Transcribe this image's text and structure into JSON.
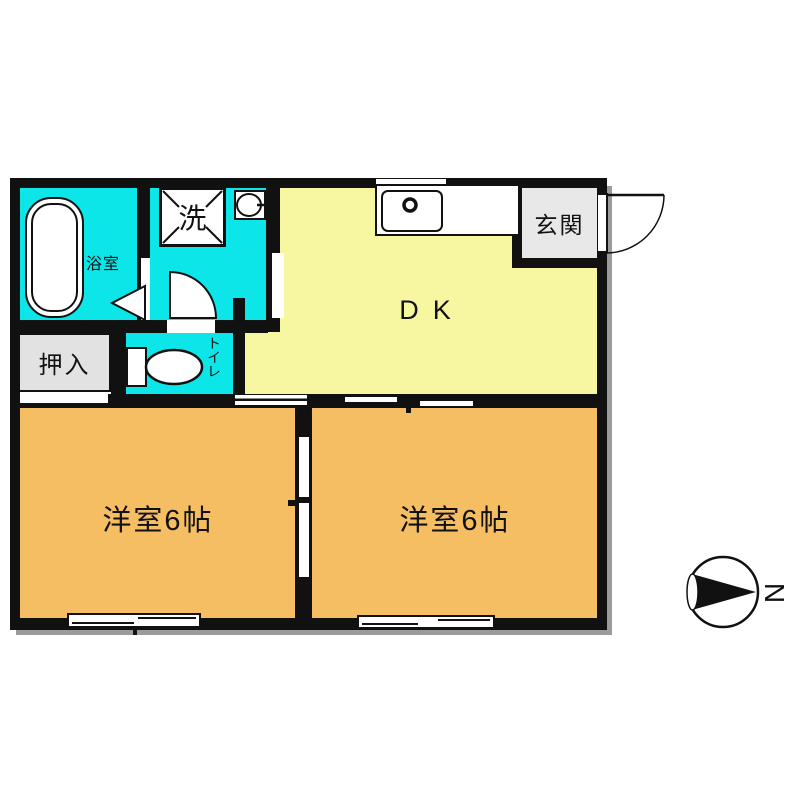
{
  "floorplan": {
    "rooms": {
      "dk": "DK",
      "bedroom_left": "洋室6帖",
      "bedroom_right": "洋室6帖",
      "bath": "浴室",
      "washer": "洗",
      "toilet": "トイレ",
      "closet": "押入",
      "entrance": "玄関"
    },
    "compass": {
      "north": "N"
    },
    "colors": {
      "wet": "#0ce6e9",
      "dk": "#f8f7a1",
      "room": "#f6be63",
      "entry": "#e8e8e8",
      "closet": "#e2e2e2",
      "wall": "#111111",
      "shadow": "#9b9b9b"
    }
  }
}
